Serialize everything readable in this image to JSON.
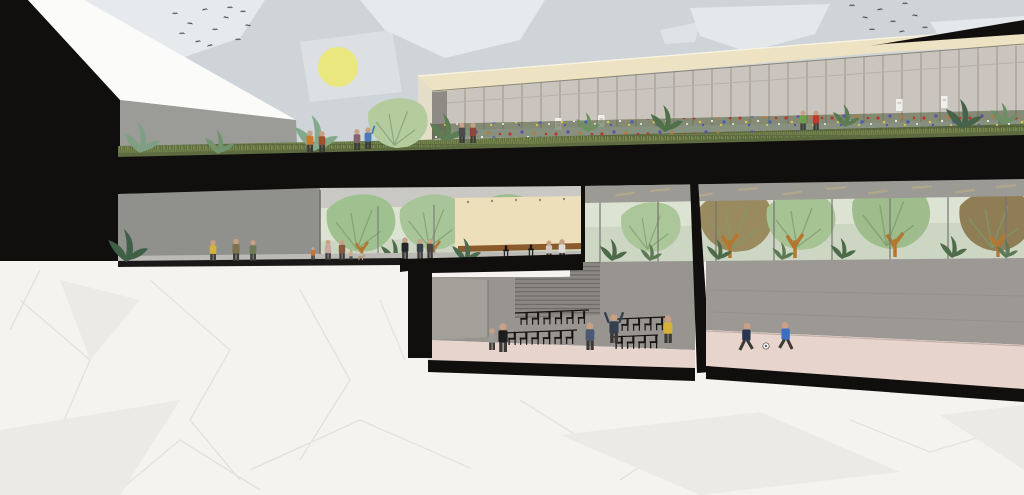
{
  "scene": {
    "description": "Architectural cross-section perspective illustration of a multi-level community building: a green roof terrace with wildflower meadow in front of a glazed upper hall, a ground-floor gallery with indoor trees and a cafe counter, a basement auditorium with chair rows and a basement sports hall, all set on a crumpled white-paper ground under a pale sky with sun, clouds and birds. No text appears in the image.",
    "sun": {
      "label": "pale-yellow-sun"
    },
    "birds": {
      "left_flock_count": 12,
      "right_flock_count": 9
    },
    "left_building": {
      "label": "black-gabled-building-with-white-roof-plane"
    },
    "upper_hall": {
      "label": "glazed-upper-hall",
      "features": [
        "cream-fascia-band",
        "black-roof-edge",
        "curtain-wall-mullions",
        "four-white-posters",
        "wildflower-roof-meadow"
      ]
    },
    "roof_terrace": {
      "label": "green-roof-terrace",
      "people_count": 8,
      "features": [
        "large-leafy-tree",
        "shrubs",
        "grass-strip"
      ]
    },
    "ground_floor": {
      "label": "ground-floor-gallery",
      "people_count": 10,
      "features": [
        "indoor-trees-behind-glass",
        "walking-visitors",
        "dog",
        "potted-plant"
      ]
    },
    "cafe": {
      "label": "cafe-mezzanine",
      "features": [
        "cream-wall",
        "wood-counter",
        "two-bar-stools",
        "plant",
        "two-people"
      ]
    },
    "middle_hall": {
      "label": "glazed-middle-hall",
      "hanging_lights_count": 10,
      "features": [
        "trees-behind-glass",
        "shrubs"
      ]
    },
    "auditorium": {
      "label": "basement-auditorium",
      "chair_rows": [
        6,
        6,
        4,
        4
      ],
      "people_count": 5,
      "features": [
        "stair-bleachers",
        "photographer-with-raised-arms"
      ]
    },
    "sports_hall": {
      "label": "basement-sports-hall",
      "people_count": 2,
      "features": [
        "two-children-playing-football",
        "football"
      ]
    },
    "ground": {
      "label": "crumpled-paper-ground"
    }
  },
  "palette": {
    "sky": "#ced4d8",
    "cloud": "#e7eaec",
    "sun": "#e9e77d",
    "ink": "#100f0d",
    "paper": "#f4f3f0",
    "crease": "#e1dfdb",
    "creaseSoft": "#eceae6",
    "white-roof": "#fbfbfa",
    "parapet": "#9b9b97",
    "fascia": "#ede2c1",
    "glassUp": "#c9c5be",
    "mullUp": "#a19b90",
    "grass": "#5d6b40",
    "grassBlade": "#7e9050",
    "meadow": "#4c5a36",
    "wallIn": "#90908d",
    "ceilIn": "#c9c8c4",
    "sage": "#cdd6c3",
    "sageLight": "#dde3d2",
    "cream": "#ecdfba",
    "counter": "#8a5a2d",
    "wallB": "#989590",
    "wallR": "#9c9995",
    "floorPink": "#e7d4cd",
    "floorStrip": "#bcbab5",
    "treeLight": "#b4cb9e",
    "treeVein": "#7d9b6e",
    "trunk": "#b5772f",
    "shrubDark": "#4d6b49",
    "lightbar": "#b3a78a",
    "stairs": "#8b8883",
    "stairLine": "#66645f",
    "poster": "#efefec",
    "skin": "#c9a084",
    "leg": "#3c3a38",
    "bird": "#44403a",
    "flowerRed": "#b23a2e",
    "flowerOrange": "#c8742e",
    "flowerPurple": "#5c55a6",
    "flowerBlue": "#4a5fae",
    "flowerYellow": "#d8c14f",
    "flowerWhite": "#eeeee8",
    "ball": "#efefed"
  },
  "figure_colors": {
    "yellow": "#d4b23a",
    "orange": "#c87a2f",
    "rust": "#a2502c",
    "mauve": "#85656c",
    "blue": "#4a7ab5",
    "darkgray": "#4a4a4c",
    "darkred": "#8a4a3a",
    "green": "#6fa04a",
    "red": "#c0392b",
    "olive": "#7b7350",
    "olivegreen": "#6e7a52",
    "kidorange": "#cc6f2d",
    "pink": "#caa9a0",
    "brown": "#8a5a3f",
    "tan": "#c9b08a",
    "suit": "#26262a",
    "navy": "#3a3f4a",
    "charcoal": "#4a4540",
    "whiteshirt": "#dedcd8",
    "creamtop": "#cfc9c2",
    "gray": "#9a9a98",
    "black": "#1f1d1c",
    "denim": "#4a5a74",
    "photog": "#35404f",
    "navykid": "#2a3550",
    "bluekid": "#3a6fc4",
    "chair": "#171513",
    "stool": "#151413",
    "dog": "#b59a7a"
  }
}
